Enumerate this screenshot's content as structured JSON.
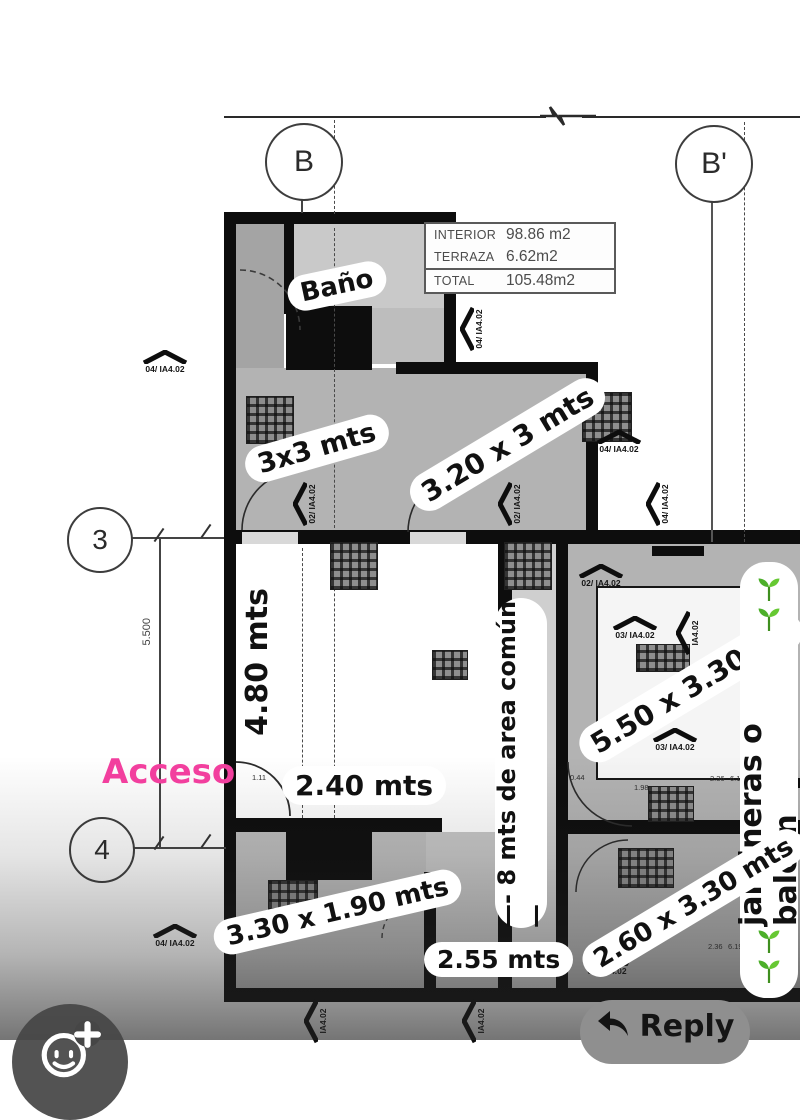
{
  "stickers": {
    "bano": "Baño",
    "room_3x3": "3x3 mts",
    "room_320x3": "3.20 x 3 mts",
    "dim_480": "4.80 mts",
    "acceso": "Acceso",
    "dim_240": "2.40 mts",
    "common_area": "—- 8 mts de area común —",
    "room_550x330": "5.50 x 3.30 mt",
    "jardineras": "jardineras o balcón",
    "room_330x190": "3.30 x 1.90 mts",
    "dim_255": "2.55 mts",
    "room_260x330": "2.60 x 3.30 mts"
  },
  "area_table": {
    "rows": [
      {
        "label": "INTERIOR",
        "value": "98.86 m2"
      },
      {
        "label": "TERRAZA",
        "value": "6.62m2"
      },
      {
        "label": "TOTAL",
        "value": "105.48m2"
      }
    ]
  },
  "grid": {
    "b": "B",
    "b_prime": "B'",
    "row_3": "3",
    "row_4": "4",
    "dim_left": "5.500"
  },
  "markers": [
    {
      "text": "04/ IA4.02"
    },
    {
      "text": "04/ IA4.02"
    },
    {
      "text": "04/ IA4.02"
    },
    {
      "text": "04/ IA4.02"
    },
    {
      "text": "02/ IA4.02"
    },
    {
      "text": "02/ IA4.02"
    },
    {
      "text": "02/ IA4.02"
    },
    {
      "text": "03/ IA4.02"
    },
    {
      "text": "IA4.02"
    },
    {
      "text": "03/ IA4.02"
    },
    {
      "text": "04/ IA4.02"
    },
    {
      "text": "02/ IA4.02"
    },
    {
      "text": "IA4.02"
    },
    {
      "text": "IA4.02"
    }
  ],
  "tiny_dims": [
    {
      "text": "1.11"
    },
    {
      "text": "2.57"
    },
    {
      "text": "0.44"
    },
    {
      "text": "1.98"
    },
    {
      "text": "2.36"
    },
    {
      "text": "6.19"
    },
    {
      "text": "2.50"
    },
    {
      "text": "2.36"
    },
    {
      "text": "6.19"
    }
  ],
  "controls": {
    "reply": "Reply"
  },
  "icons": {
    "reaction_button": "add-reaction-smiley-plus-icon",
    "reply_button": "reply-arrow-icon",
    "jardineras": "seedling-icon"
  },
  "colors": {
    "accent_pink": "#f23f9e",
    "seedling_green": "#58b42c",
    "sticker_bg": "#ffffff",
    "plan_ink": "#0d0d0d"
  }
}
